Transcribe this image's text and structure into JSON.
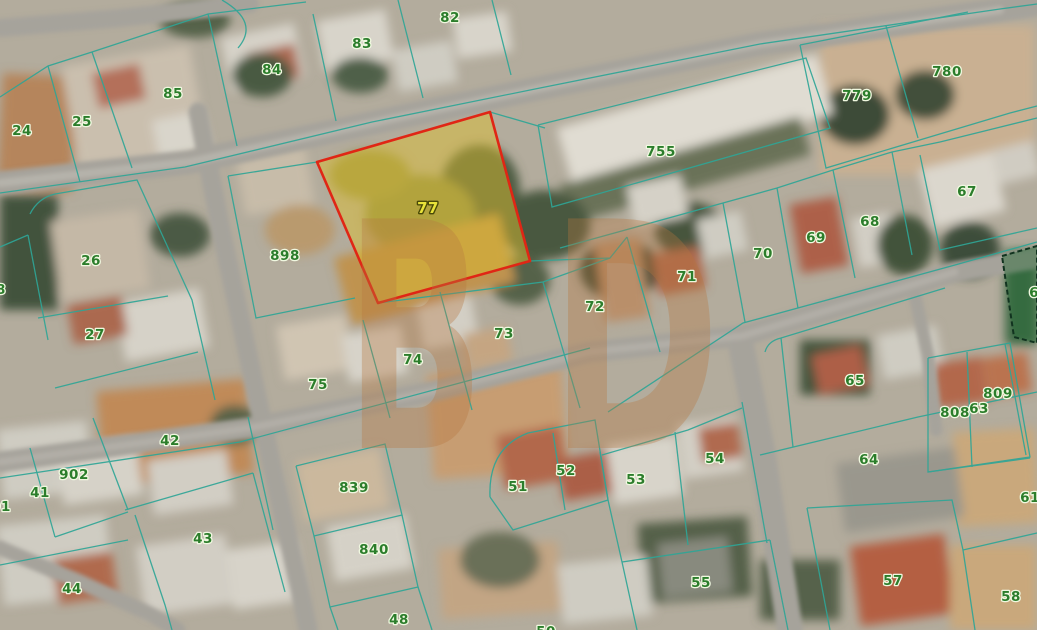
{
  "map": {
    "type": "cadastral-satellite-map",
    "boundary_line_color": "#2fa596",
    "label_style": {
      "color": "#2b7d2b",
      "halo": "#f0f8e0"
    },
    "watermark": {
      "text": "BD",
      "color": "#b5773f"
    },
    "highlight_parcel": {
      "number": "77",
      "fill": "#ddbf2e",
      "stroke": "#e02615",
      "label_color": "#e8e23a",
      "label_halo": "#4a4a08",
      "label_x": 428,
      "label_y": 213
    },
    "green_parcel": {
      "number": "66",
      "fill": "#2e6b3c",
      "stroke": "#11331f"
    },
    "labels": [
      {
        "t": "24",
        "x": 22,
        "y": 135
      },
      {
        "t": "25",
        "x": 82,
        "y": 126
      },
      {
        "t": "85",
        "x": 173,
        "y": 98
      },
      {
        "t": "84",
        "x": 272,
        "y": 74
      },
      {
        "t": "83",
        "x": 362,
        "y": 48
      },
      {
        "t": "82",
        "x": 450,
        "y": 22
      },
      {
        "t": "779",
        "x": 857,
        "y": 100
      },
      {
        "t": "780",
        "x": 947,
        "y": 76
      },
      {
        "t": "755",
        "x": 661,
        "y": 156
      },
      {
        "t": "67",
        "x": 967,
        "y": 196
      },
      {
        "t": "68",
        "x": 870,
        "y": 226
      },
      {
        "t": "69",
        "x": 816,
        "y": 242
      },
      {
        "t": "70",
        "x": 763,
        "y": 258
      },
      {
        "t": "71",
        "x": 687,
        "y": 281
      },
      {
        "t": "72",
        "x": 595,
        "y": 311
      },
      {
        "t": "898",
        "x": 285,
        "y": 260
      },
      {
        "t": "26",
        "x": 91,
        "y": 265
      },
      {
        "t": "27",
        "x": 95,
        "y": 339
      },
      {
        "t": "28",
        "x": -4,
        "y": 294
      },
      {
        "t": "73",
        "x": 504,
        "y": 338
      },
      {
        "t": "74",
        "x": 413,
        "y": 364
      },
      {
        "t": "75",
        "x": 318,
        "y": 389
      },
      {
        "t": "65",
        "x": 855,
        "y": 385
      },
      {
        "t": "66",
        "x": 1039,
        "y": 297
      },
      {
        "t": "42",
        "x": 170,
        "y": 445
      },
      {
        "t": "902",
        "x": 74,
        "y": 479
      },
      {
        "t": "41",
        "x": 40,
        "y": 497
      },
      {
        "t": "901",
        "x": -4,
        "y": 511
      },
      {
        "t": "43",
        "x": 203,
        "y": 543
      },
      {
        "t": "44",
        "x": 72,
        "y": 593
      },
      {
        "t": "839",
        "x": 354,
        "y": 492
      },
      {
        "t": "840",
        "x": 374,
        "y": 554
      },
      {
        "t": "48",
        "x": 399,
        "y": 624
      },
      {
        "t": "51",
        "x": 518,
        "y": 491
      },
      {
        "t": "52",
        "x": 566,
        "y": 475
      },
      {
        "t": "53",
        "x": 636,
        "y": 484
      },
      {
        "t": "54",
        "x": 715,
        "y": 463
      },
      {
        "t": "55",
        "x": 701,
        "y": 587
      },
      {
        "t": "57",
        "x": 893,
        "y": 585
      },
      {
        "t": "58",
        "x": 1011,
        "y": 601
      },
      {
        "t": "64",
        "x": 869,
        "y": 464
      },
      {
        "t": "61",
        "x": 1030,
        "y": 502
      },
      {
        "t": "808",
        "x": 955,
        "y": 417
      },
      {
        "t": "63",
        "x": 979,
        "y": 413
      },
      {
        "t": "809",
        "x": 998,
        "y": 398
      },
      {
        "t": "50",
        "x": 546,
        "y": 636
      }
    ]
  }
}
